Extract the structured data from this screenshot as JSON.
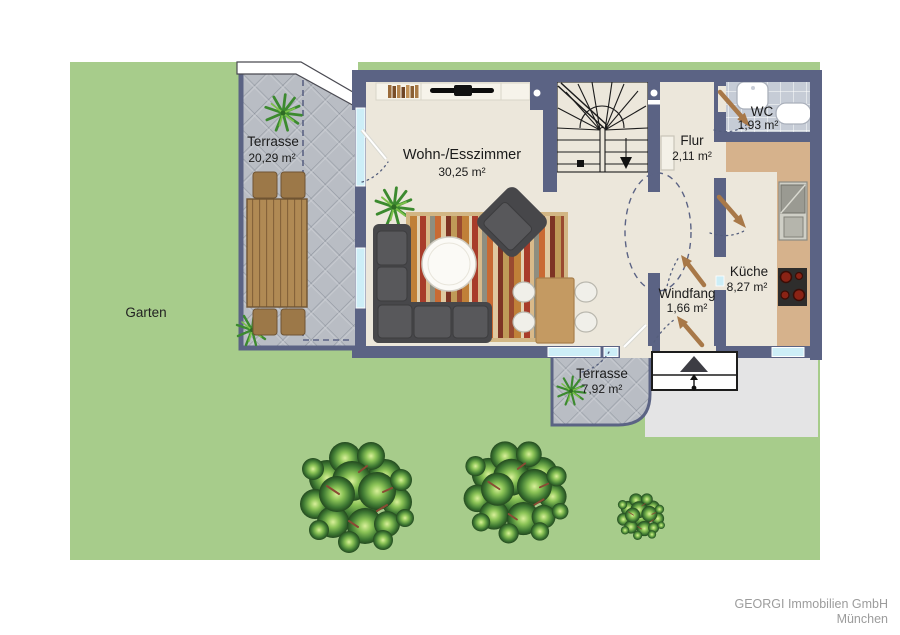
{
  "garden": {
    "label": "Garten"
  },
  "rooms": {
    "terrace_large": {
      "label": "Terrasse",
      "area": "20,29 m²"
    },
    "living_dining": {
      "label": "Wohn-/Esszimmer",
      "area": "30,25 m²"
    },
    "hallway": {
      "label": "Flur",
      "area": "2,11 m²"
    },
    "wc": {
      "label": "WC",
      "area": "1,93 m²"
    },
    "kitchen": {
      "label": "Küche",
      "area": "8,27 m²"
    },
    "vestibule": {
      "label": "Windfang",
      "area": "1,66 m²"
    },
    "terrace_small": {
      "label": "Terrasse",
      "area": "7,92 m²"
    }
  },
  "footer": {
    "company": "GEORGI Immobilien GmbH",
    "city": "München"
  },
  "colors": {
    "wall": "#5b6384",
    "floor": "#ece7db",
    "garden_green": "#a7cc8b",
    "terrace_tiles": "#b9bdc4",
    "kitchen_counter": "#d6b28c",
    "window_glass": "#cdeef7",
    "paving": "#e4e4e5",
    "wc_tiles": "#c6ccd6",
    "door_arrow": "#a87848"
  }
}
